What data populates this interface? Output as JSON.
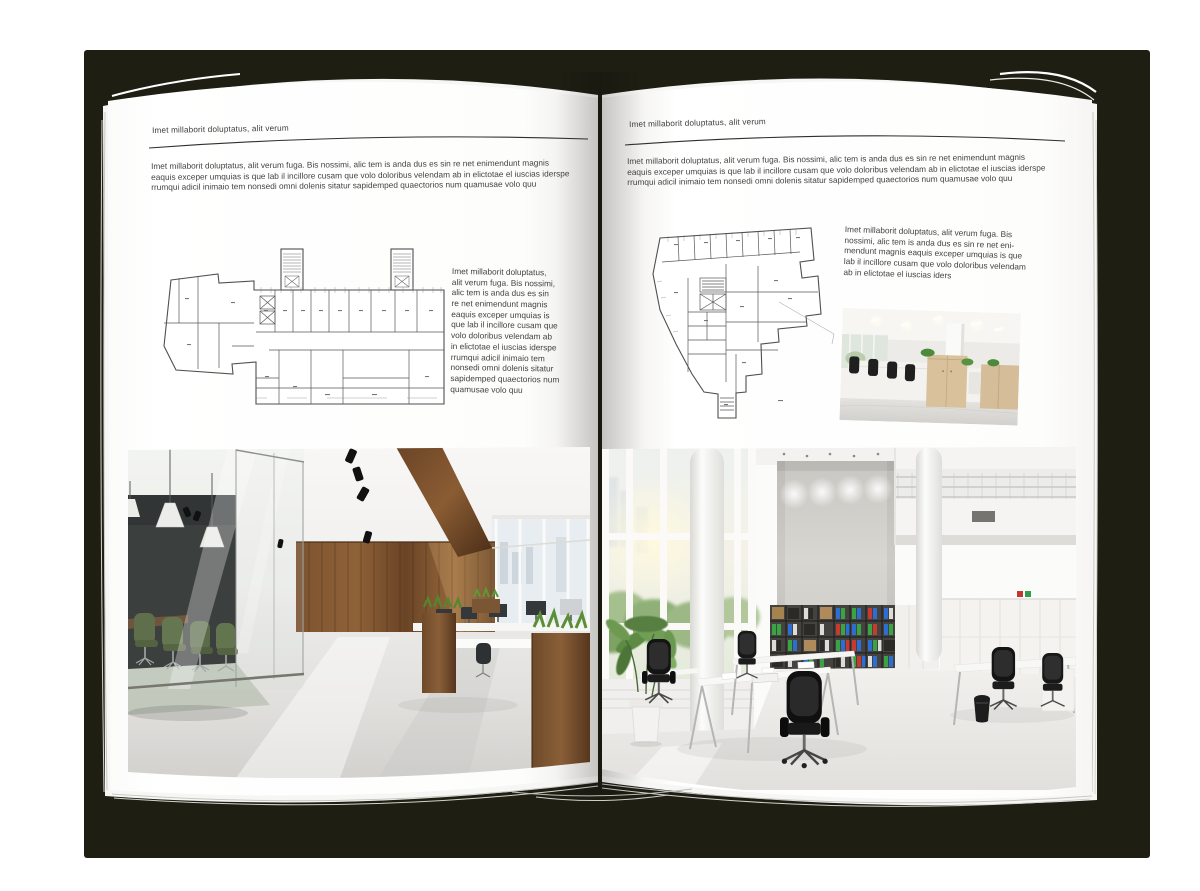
{
  "document": {
    "kind": "interior-design brochure spread (open magazine mockup)",
    "colors": {
      "backdrop": "#1f1e13",
      "page": "#ffffff",
      "rule": "#2f2f2f",
      "text": "#424242"
    },
    "left_page": {
      "kicker": "Imet millaborit doluptatus, alit verum",
      "intro": "Imet millaborit doluptatus, alit verum fuga. Bis nossimi, alic tem is anda dus es sin re net enimendunt magnis\neaquis exceper umquias is que lab il incillore cusam que volo doloribus velendam ab in elictotae el iuscias iderspe\nrrumqui adicil inimaio tem nonsedi omni dolenis sitatur sapidemped quaectorios num quamusae volo quu",
      "sidenote": "Imet millaborit doluptatus,\nalit verum fuga. Bis nossimi,\nalic tem is anda dus es sin\nre net enimendunt magnis\neaquis exceper umquias is\nque lab il incillore cusam que\nvolo doloribus velendam ab\nin elictotae el iuscias iderspe\nrrumqui adicil inimaio tem\nnonsedi omni dolenis sitatur\nsapidemped quaectorios num\nquamusae volo quu"
    },
    "right_page": {
      "kicker": "Imet millaborit doluptatus, alit verum",
      "intro": "Imet millaborit doluptatus, alit verum fuga. Bis nossimi, alic tem is anda dus es sin re net enimendunt magnis\neaquis exceper umquias is que lab il incillore cusam que volo doloribus velendam ab in elictotae el iuscias iderspe\nrrumqui adicil inimaio tem nonsedi omni dolenis sitatur sapidemped quaectorios num quamusae volo quu",
      "sidenote": "Imet millaborit doluptatus, alit verum fuga. Bis\nnossimi, alic tem is anda dus es sin re net eni-\nmendunt magnis eaquis exceper umquias is que\nlab il incillore cusam que volo doloribus velendam\nab in elictotae el iuscias iders"
    },
    "figures": {
      "left_plan": "architectural floor plan",
      "right_plan": "architectural floor plan",
      "left_photo": "loft office photo",
      "right_photo": "white atrium office photo",
      "small_photo": "open-plan office photo"
    }
  }
}
